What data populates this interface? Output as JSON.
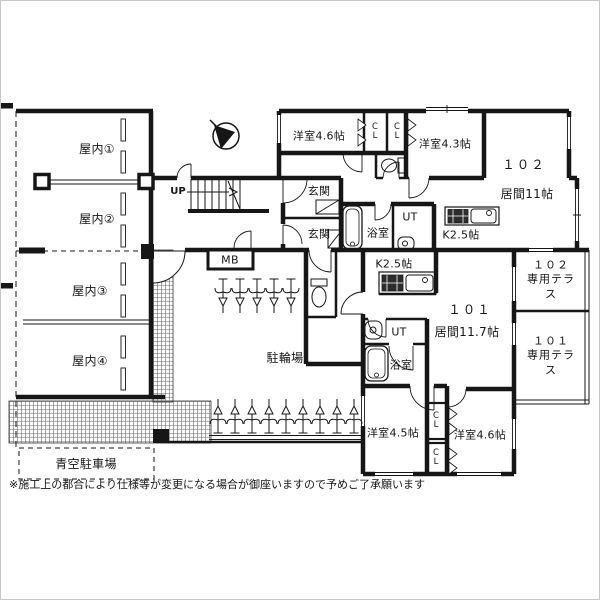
{
  "colors": {
    "line": "#161616",
    "hatch": "#666666",
    "background": "#ffffff"
  },
  "garage": {
    "space1": "屋内①",
    "space2": "屋内②",
    "space3": "屋内③",
    "space4": "屋内④",
    "open_lot": "青空駐車場"
  },
  "common": {
    "bike_parking": "駐輪場",
    "meter_box": "MB",
    "stairs_up": "UP"
  },
  "u102": {
    "no": "１０２",
    "living": "居間11帖",
    "kitchen": "K2.5帖",
    "bath": "浴室",
    "ut": "UT",
    "entrance": "玄関",
    "room46": "洋室4.6帖",
    "room43": "洋室4.3帖",
    "cl1": "CL",
    "cl2": "CL",
    "terrace": "１０２\n専用テラス"
  },
  "u101": {
    "no": "１０１",
    "living": "居間11.7帖",
    "kitchen": "K2.5帖",
    "bath": "浴室",
    "ut": "UT",
    "entrance": "玄関",
    "room45": "洋室4.5帖",
    "room46": "洋室4.6帖",
    "cl1": "CL",
    "cl2": "CL",
    "terrace": "１０１\n専用テラス"
  },
  "footer": {
    "disclaimer": "※施工上の都合により仕様等が変更になる場合が御座いますので予めご了承願います"
  }
}
